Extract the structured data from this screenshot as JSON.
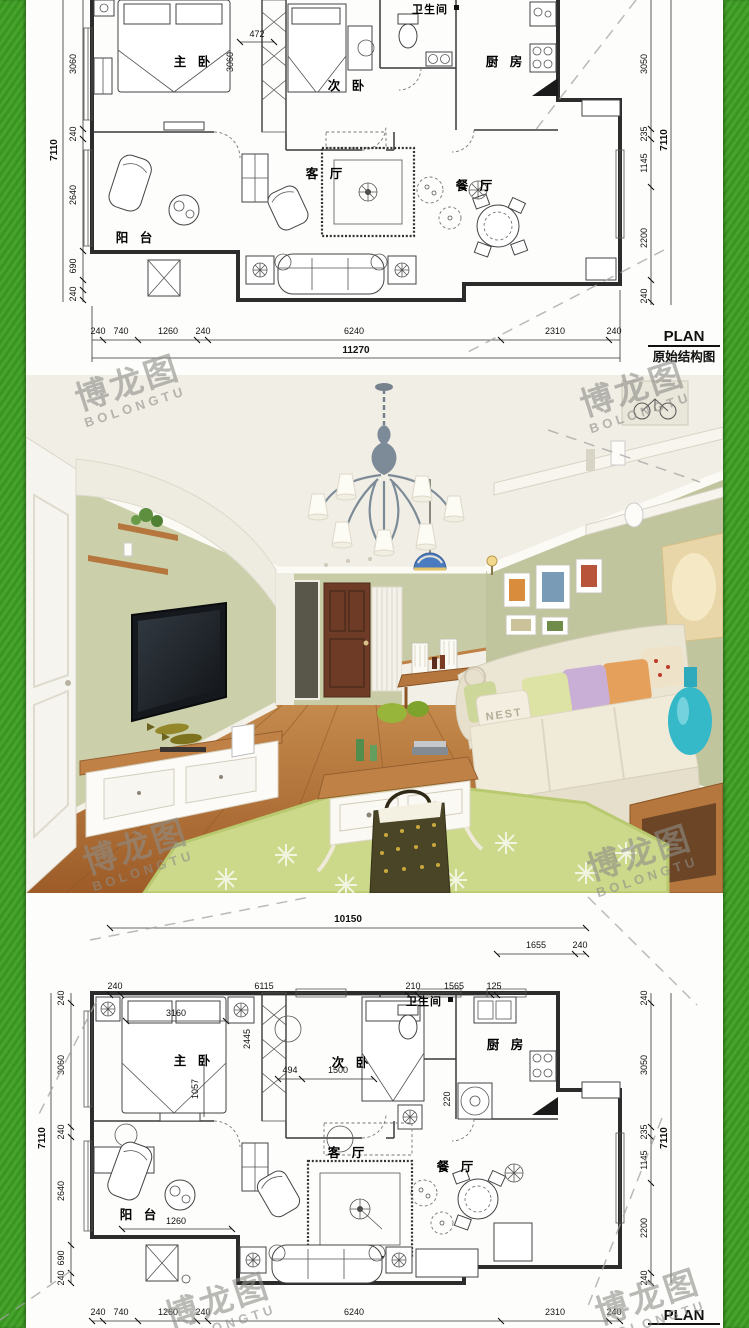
{
  "watermark": {
    "cn": "博龙图",
    "en": "BOLONGTU"
  },
  "photo": {
    "pillow_text": "NEST"
  },
  "plan_top": {
    "label_plan": "PLAN",
    "label_title": "原始结构图",
    "rooms": {
      "master": "主 卧",
      "second": "次 卧",
      "bath": "卫生间",
      "kitchen": "厨 房",
      "living": "客 厅",
      "dining": "餐 厅",
      "balcony": "阳 台"
    },
    "dims": {
      "left": [
        "3060",
        "240",
        "2640",
        "690",
        "240"
      ],
      "left_total": "7110",
      "right": [
        "3050",
        "235",
        "1145",
        "2200",
        "240"
      ],
      "right_total": "7110",
      "bottom": [
        "240",
        "740",
        "1260",
        "240",
        "6240",
        "2310",
        "240"
      ],
      "bottom_total": "11270",
      "internal": [
        "472",
        "3060"
      ]
    }
  },
  "plan_bottom": {
    "label_plan": "PLAN",
    "label_title": "平面布置图",
    "rooms": {
      "master": "主 卧",
      "second": "次 卧",
      "bath": "卫生间",
      "kitchen": "厨 房",
      "living": "客 厅",
      "dining": "餐 厅",
      "balcony": "阳 台"
    },
    "dims": {
      "top_total": "10150",
      "top_right": [
        "1655",
        "240"
      ],
      "top": [
        "240",
        "6115",
        "210",
        "1565",
        "125"
      ],
      "left": [
        "240",
        "3060",
        "240",
        "2640",
        "690",
        "240"
      ],
      "left_total": "7110",
      "right": [
        "240",
        "3050",
        "235",
        "1145",
        "2200",
        "240"
      ],
      "right_total": "7110",
      "bottom": [
        "240",
        "740",
        "1260",
        "240",
        "6240",
        "2310",
        "240"
      ],
      "internal": [
        "3160",
        "2445",
        "1057",
        "494",
        "1500",
        "220",
        "1260"
      ]
    }
  }
}
